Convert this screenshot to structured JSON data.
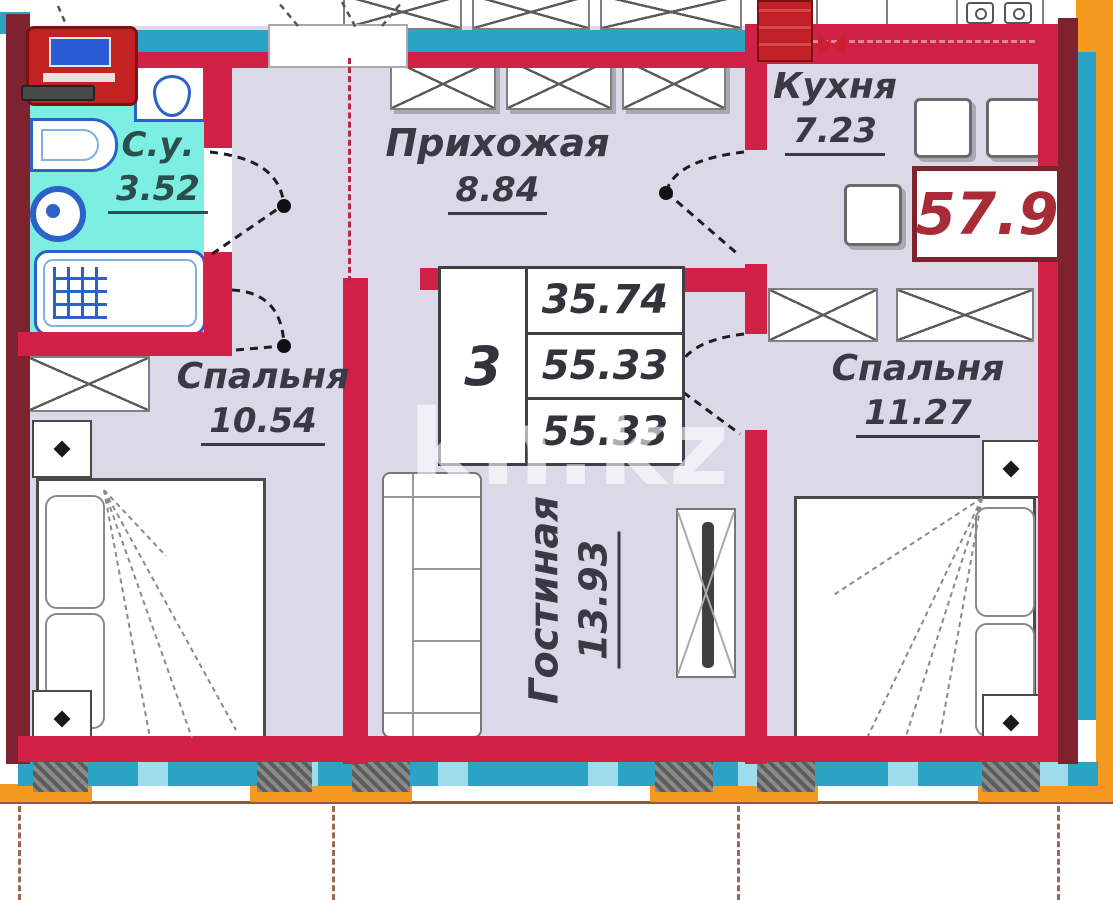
{
  "plan": {
    "watermark": "kn.kz",
    "total_area": "57.9",
    "summary_table": {
      "rooms_count": "3",
      "area_1": "35.74",
      "area_2": "55.33",
      "area_3": "55.33"
    },
    "rooms": {
      "bathroom": {
        "name": "С.у.",
        "area": "3.52"
      },
      "hallway": {
        "name": "Прихожая",
        "area": "8.84"
      },
      "kitchen": {
        "name": "Кухня",
        "area": "7.23"
      },
      "bedroom_left": {
        "name": "Спальня",
        "area": "10.54"
      },
      "bedroom_right": {
        "name": "Спальня",
        "area": "11.27"
      },
      "living_room": {
        "name": "Гостиная",
        "area": "13.93"
      }
    },
    "colors": {
      "wall": "#d22147",
      "wall_dark": "#7e2230",
      "bathroom_fill": "#7deee2",
      "room_fill": "#dbd9e8",
      "window_band": "#2aa3c4",
      "outside_band": "#f49a1f",
      "total_area_color": "#a72c38"
    }
  }
}
